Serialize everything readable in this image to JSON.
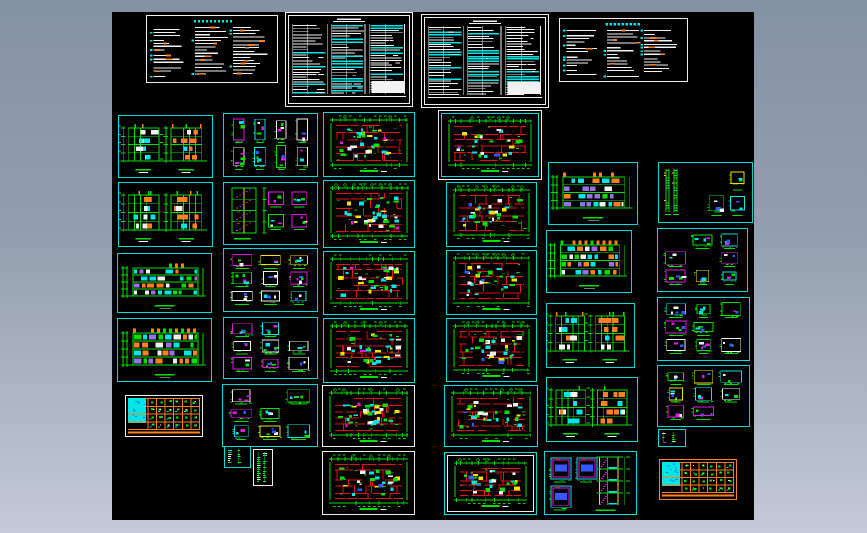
{
  "app": {
    "name": "cad-drawing-set-preview",
    "background": {
      "top": "#8492a5",
      "mid": "#939fb0",
      "bottom": "#c4cad6"
    },
    "canvas": {
      "x": 112,
      "y": 12,
      "width": 642,
      "height": 508,
      "color": "#000000"
    }
  },
  "palette": {
    "green": "#00e000",
    "red": "#e81010",
    "cyan": "#00e5e5",
    "magenta": "#e814e8",
    "orange": "#ff8020",
    "yellow": "#f5e400",
    "white": "#f2f2f2",
    "blue": "#3858ff",
    "purple": "#9a70e8"
  },
  "border_colors": {
    "cyan": "#00dcdc",
    "white": "#efefef",
    "orange": "#ff8020"
  },
  "sheets": [
    {
      "id": "notes-1",
      "name": "general-notes-sheet",
      "type": "notes",
      "x": 34,
      "y": 3,
      "w": 132,
      "h": 68,
      "border": "white",
      "inner": "",
      "variant": "",
      "seed": 101
    },
    {
      "id": "spec-1",
      "name": "specification-table-sheet",
      "type": "spec",
      "x": 173,
      "y": 0,
      "w": 128,
      "h": 95,
      "border": "white",
      "inner": "white",
      "variant": "",
      "seed": 102
    },
    {
      "id": "spec-2",
      "name": "specification-table-sheet",
      "type": "spec",
      "x": 309,
      "y": 2,
      "w": 128,
      "h": 94,
      "border": "white",
      "inner": "white",
      "variant": "",
      "seed": 103
    },
    {
      "id": "notes-2",
      "name": "general-notes-sheet",
      "type": "notes",
      "x": 447,
      "y": 6,
      "w": 129,
      "h": 64,
      "border": "white",
      "inner": "",
      "variant": "",
      "seed": 104
    },
    {
      "id": "elev-a1",
      "name": "building-elevation-sheet",
      "type": "elevpair",
      "x": 6,
      "y": 103,
      "w": 95,
      "h": 63,
      "border": "cyan",
      "inner": "",
      "variant": "",
      "seed": 105
    },
    {
      "id": "elev-a2",
      "name": "building-elevation-sheet",
      "type": "elevpair",
      "x": 6,
      "y": 170,
      "w": 95,
      "h": 65,
      "border": "cyan",
      "inner": "",
      "variant": "",
      "seed": 106
    },
    {
      "id": "elev-a3",
      "name": "building-elevation-sheet",
      "type": "elevlong",
      "x": 5,
      "y": 241,
      "w": 95,
      "h": 60,
      "border": "cyan",
      "inner": "",
      "variant": "mixed",
      "seed": 107
    },
    {
      "id": "elev-a4",
      "name": "building-elevation-sheet",
      "type": "elevlong",
      "x": 5,
      "y": 306,
      "w": 95,
      "h": 64,
      "border": "cyan",
      "inner": "",
      "variant": "orange",
      "seed": 108
    },
    {
      "id": "schedule-a",
      "name": "door-window-schedule-sheet",
      "type": "schedule",
      "x": 13,
      "y": 383,
      "w": 78,
      "h": 42,
      "border": "white",
      "inner": "",
      "variant": "",
      "seed": 109
    },
    {
      "id": "details-b1",
      "name": "window-details-sheet",
      "type": "details",
      "x": 111,
      "y": 101,
      "w": 95,
      "h": 64,
      "border": "cyan",
      "inner": "",
      "variant": "tall",
      "seed": 110
    },
    {
      "id": "stair-b2",
      "name": "stair-details-sheet",
      "type": "stair",
      "x": 111,
      "y": 170,
      "w": 95,
      "h": 63,
      "border": "cyan",
      "inner": "",
      "variant": "detail",
      "seed": 111
    },
    {
      "id": "details-b3",
      "name": "construction-details-sheet",
      "type": "details",
      "x": 111,
      "y": 236,
      "w": 95,
      "h": 64,
      "border": "cyan",
      "inner": "",
      "variant": "",
      "seed": 112
    },
    {
      "id": "details-b4",
      "name": "construction-details-sheet",
      "type": "details",
      "x": 111,
      "y": 305,
      "w": 95,
      "h": 62,
      "border": "cyan",
      "inner": "",
      "variant": "",
      "seed": 113
    },
    {
      "id": "details-b5",
      "name": "construction-details-sheet",
      "type": "details",
      "x": 110,
      "y": 372,
      "w": 96,
      "h": 63,
      "border": "cyan",
      "inner": "",
      "variant": "",
      "seed": 114
    },
    {
      "id": "strips-b6",
      "name": "small-detail-sheet",
      "type": "strips",
      "x": 112,
      "y": 434,
      "w": 27,
      "h": 22,
      "border": "cyan",
      "inner": "",
      "variant": "",
      "seed": 115
    },
    {
      "id": "strips-b7",
      "name": "small-detail-sheet",
      "type": "strips",
      "x": 141,
      "y": 437,
      "w": 20,
      "h": 37,
      "border": "white",
      "inner": "",
      "variant": "",
      "seed": 116
    },
    {
      "id": "plan-c1",
      "name": "floor-plan-sheet",
      "type": "plan",
      "x": 211,
      "y": 100,
      "w": 92,
      "h": 65,
      "border": "cyan",
      "inner": "",
      "variant": "colorful",
      "seed": 117
    },
    {
      "id": "plan-c2",
      "name": "floor-plan-sheet",
      "type": "plan",
      "x": 211,
      "y": 168,
      "w": 92,
      "h": 68,
      "border": "cyan",
      "inner": "",
      "variant": "colorful",
      "seed": 118
    },
    {
      "id": "plan-c3",
      "name": "floor-plan-sheet",
      "type": "plan",
      "x": 211,
      "y": 239,
      "w": 92,
      "h": 64,
      "border": "cyan",
      "inner": "",
      "variant": "colorful",
      "seed": 119
    },
    {
      "id": "plan-c4",
      "name": "floor-plan-sheet",
      "type": "plan",
      "x": 211,
      "y": 306,
      "w": 92,
      "h": 65,
      "border": "cyan",
      "inner": "",
      "variant": "colorful",
      "seed": 120
    },
    {
      "id": "plan-c5",
      "name": "floor-plan-sheet",
      "type": "plan",
      "x": 210,
      "y": 373,
      "w": 93,
      "h": 62,
      "border": "white",
      "inner": "",
      "variant": "colorful",
      "seed": 121
    },
    {
      "id": "plan-c6",
      "name": "floor-plan-sheet",
      "type": "plan",
      "x": 210,
      "y": 439,
      "w": 93,
      "h": 64,
      "border": "white",
      "inner": "",
      "variant": "red",
      "seed": 122
    },
    {
      "id": "plan-d1",
      "name": "floor-plan-sheet",
      "type": "plan",
      "x": 326,
      "y": 98,
      "w": 104,
      "h": 70,
      "border": "white",
      "inner": "cyan",
      "variant": "red",
      "seed": 123
    },
    {
      "id": "plan-d2",
      "name": "floor-plan-sheet",
      "type": "plan",
      "x": 334,
      "y": 170,
      "w": 91,
      "h": 65,
      "border": "cyan",
      "inner": "",
      "variant": "red",
      "seed": 124
    },
    {
      "id": "plan-d3",
      "name": "floor-plan-sheet",
      "type": "plan",
      "x": 334,
      "y": 238,
      "w": 91,
      "h": 65,
      "border": "cyan",
      "inner": "",
      "variant": "red",
      "seed": 125
    },
    {
      "id": "plan-d4",
      "name": "floor-plan-sheet",
      "type": "plan",
      "x": 334,
      "y": 306,
      "w": 91,
      "h": 64,
      "border": "cyan",
      "inner": "",
      "variant": "red",
      "seed": 126
    },
    {
      "id": "plan-d5",
      "name": "floor-plan-sheet",
      "type": "plan",
      "x": 332,
      "y": 373,
      "w": 94,
      "h": 62,
      "border": "cyan",
      "inner": "",
      "variant": "red",
      "seed": 127
    },
    {
      "id": "plan-d6",
      "name": "floor-plan-sheet",
      "type": "plan",
      "x": 332,
      "y": 440,
      "w": 93,
      "h": 63,
      "border": "cyan",
      "inner": "white",
      "variant": "red",
      "seed": 128
    },
    {
      "id": "elev-e1",
      "name": "building-elevation-sheet",
      "type": "elevlong",
      "x": 436,
      "y": 150,
      "w": 90,
      "h": 63,
      "border": "cyan",
      "inner": "",
      "variant": "mixed",
      "seed": 129
    },
    {
      "id": "elev-e2",
      "name": "building-elevation-sheet",
      "type": "elevlong",
      "x": 434,
      "y": 218,
      "w": 86,
      "h": 63,
      "border": "cyan",
      "inner": "",
      "variant": "orange",
      "seed": 130
    },
    {
      "id": "elev-e3",
      "name": "building-elevation-sheet",
      "type": "elevpair",
      "x": 434,
      "y": 291,
      "w": 89,
      "h": 65,
      "border": "cyan",
      "inner": "",
      "variant": "",
      "seed": 131
    },
    {
      "id": "elev-e4",
      "name": "building-elevation-sheet",
      "type": "elevpair",
      "x": 434,
      "y": 365,
      "w": 92,
      "h": 65,
      "border": "cyan",
      "inner": "",
      "variant": "",
      "seed": 132
    },
    {
      "id": "stair-e5",
      "name": "stair-section-sheet",
      "type": "stair",
      "x": 432,
      "y": 439,
      "w": 93,
      "h": 64,
      "border": "cyan",
      "inner": "",
      "variant": "section",
      "seed": 133
    },
    {
      "id": "details-f1",
      "name": "construction-details-sheet",
      "type": "details",
      "x": 546,
      "y": 150,
      "w": 95,
      "h": 61,
      "border": "cyan",
      "inner": "",
      "variant": "tall-left",
      "seed": 134
    },
    {
      "id": "details-f2",
      "name": "construction-details-sheet",
      "type": "details",
      "x": 545,
      "y": 216,
      "w": 91,
      "h": 64,
      "border": "cyan",
      "inner": "",
      "variant": "",
      "seed": 135
    },
    {
      "id": "details-f3",
      "name": "construction-details-sheet",
      "type": "details",
      "x": 545,
      "y": 285,
      "w": 93,
      "h": 64,
      "border": "cyan",
      "inner": "",
      "variant": "",
      "seed": 136
    },
    {
      "id": "details-f4",
      "name": "construction-details-sheet",
      "type": "details",
      "x": 545,
      "y": 353,
      "w": 93,
      "h": 62,
      "border": "cyan",
      "inner": "",
      "variant": "",
      "seed": 137
    },
    {
      "id": "strips-f5",
      "name": "small-detail-sheet",
      "type": "strips",
      "x": 546,
      "y": 417,
      "w": 28,
      "h": 18,
      "border": "cyan",
      "inner": "",
      "variant": "",
      "seed": 138
    },
    {
      "id": "schedule-f",
      "name": "door-window-schedule-sheet",
      "type": "schedule",
      "x": 547,
      "y": 447,
      "w": 78,
      "h": 41,
      "border": "orange",
      "inner": "",
      "variant": "",
      "seed": 139
    }
  ]
}
